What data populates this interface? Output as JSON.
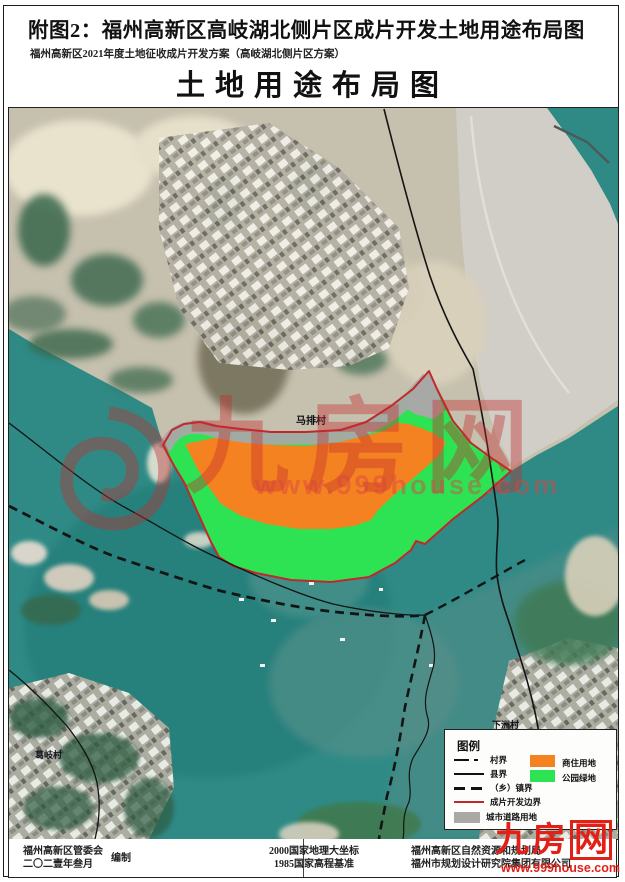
{
  "page": {
    "title": "附图2：福州高新区高岐湖北侧片区成片开发土地用途布局图",
    "subtitle": "福州高新区2021年度土地征收成片开发方案（高岐湖北侧片区方案）",
    "map_title": "土地用途布局图"
  },
  "map": {
    "labels": {
      "village_center": "马排村",
      "village_left": "葛岐村",
      "village_right": "下洲村"
    }
  },
  "legend": {
    "title": "图例",
    "line_items": [
      {
        "label": "村界",
        "style": "dash-dot"
      },
      {
        "label": "县界",
        "style": "solid"
      },
      {
        "label": "（乡）镇界",
        "style": "dashed"
      },
      {
        "label": "成片开发边界",
        "style": "red-solid"
      },
      {
        "label": "城市道路用地",
        "style": "gray-fill"
      }
    ],
    "area_items": [
      {
        "label": "商住用地",
        "color": "#F58220"
      },
      {
        "label": "公园绿地",
        "color": "#2DE353"
      }
    ]
  },
  "footer": {
    "left_org": "福州高新区管委会",
    "left_date": "二〇二壹年叁月",
    "left_role": "编制",
    "center_line1": "2000国家地理大坐标",
    "center_line2": "1985国家高程基准",
    "right_line1": "福州高新区自然资源和规划局",
    "right_line2": "福州市规划设计研究院集团有限公司"
  },
  "watermark": {
    "brand": "九房网",
    "brand_char1": "九",
    "brand_char2": "房",
    "brand_char3": "网",
    "url": "www.999house.com"
  },
  "colors": {
    "residential_commercial": "#F58220",
    "park_green": "#2DE353",
    "urban_road": "#A8A8A6",
    "development_boundary": "#C1272D",
    "water": "#2F8A86"
  }
}
